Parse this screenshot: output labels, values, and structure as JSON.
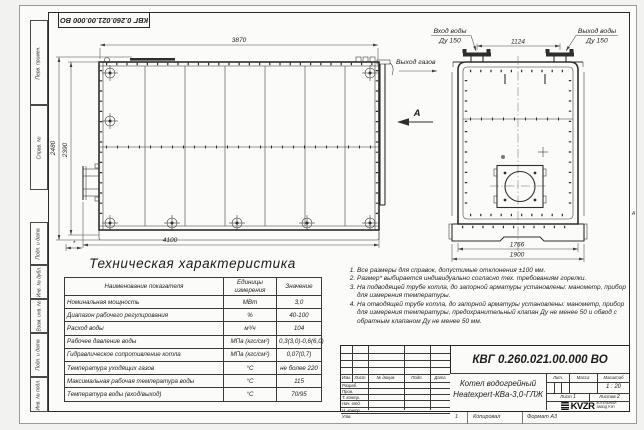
{
  "frame": {
    "stamp": "КВГ 0.260.021.00.000 ВО",
    "margin_labels": [
      "Перв. примен.",
      "Справ. №",
      "Подп. и дата",
      "Инв. № дубл.",
      "Взам. инв. №",
      "Подп. и дата",
      "Инв. № подл."
    ],
    "zone_marker": "А",
    "footer_num": "1",
    "footer_copied": "Копировал",
    "footer_format": "Формат А3"
  },
  "drawing": {
    "dims": {
      "top_width": "3870",
      "bottom_width": "4100",
      "height_outer": "2480",
      "height_inner": "2390",
      "burner_len": "*",
      "pipe_span": "1124",
      "base_inner": "1766",
      "base_outer": "1900"
    },
    "labels": {
      "water_in": "Вход воды",
      "water_in_dn": "Ду 150",
      "water_out": "Выход воды",
      "water_out_dn": "Ду 150",
      "gas_out": "Выход газов",
      "view_mark": "А"
    }
  },
  "spec": {
    "title": "Техническая характеристика",
    "headers": [
      "Наименование показателя",
      "Единицы измерения",
      "Значение"
    ],
    "rows": [
      [
        "Номинальная мощность",
        "МВт",
        "3,0"
      ],
      [
        "Диапазон рабочего регулирования",
        "%",
        "40-100"
      ],
      [
        "Расход воды",
        "м³/ч",
        "104"
      ],
      [
        "Рабочее давление воды",
        "МПа (кгс/см²)",
        "0,3(3,0)-0,6(6,0)"
      ],
      [
        "Гидравлическое сопротивление котла",
        "МПа (кгс/см²)",
        "0,07(0,7)"
      ],
      [
        "Температура уходящих газов",
        "°С",
        "не более 220"
      ],
      [
        "Максимальная рабочая температура воды",
        "°С",
        "115"
      ],
      [
        "Температура воды (вход/выход)",
        "°С",
        "70/95"
      ]
    ]
  },
  "notes": [
    "Все размеры для справок, допустимые отклонения ±100 мм.",
    "Размер* выбирается индивидуально согласно тех. требованиям горелки.",
    "На подводящей трубе котла, до запорной арматуры установлены: манометр, прибор для измерения температуры.",
    "На отводящей трубе котла, до запорной арматуры установлены: манометр, прибор для измерения температуры, предохранительный клапан Ду не менее 50 и обвод с обратным клапаном Ду не менее 50 мм."
  ],
  "title_block": {
    "doc_number": "КВГ 0.260.021.00.000 ВО",
    "product_name_1": "Котел водогрейный",
    "product_name_2": "Heatexpert-КВа-3,0-ГЛЖ",
    "cols": [
      "Изм.",
      "Лист",
      "№ докум.",
      "Подп.",
      "Дата"
    ],
    "roles": [
      "Разраб.",
      "Пров.",
      "Т. контр.",
      "Нач. отд.",
      "Н. контр.",
      "Утв."
    ],
    "lit": "Лит.",
    "mass": "Масса",
    "scale": "Масштаб",
    "scale_value": "1 : 20",
    "sheet": "Лист",
    "sheet_no": "1",
    "sheets": "Листов",
    "sheets_no": "2",
    "logo": "KVZR",
    "logo_line1": "КОТЕЛЬНЫЙ",
    "logo_line2": "ЗАВОД РЭП"
  }
}
